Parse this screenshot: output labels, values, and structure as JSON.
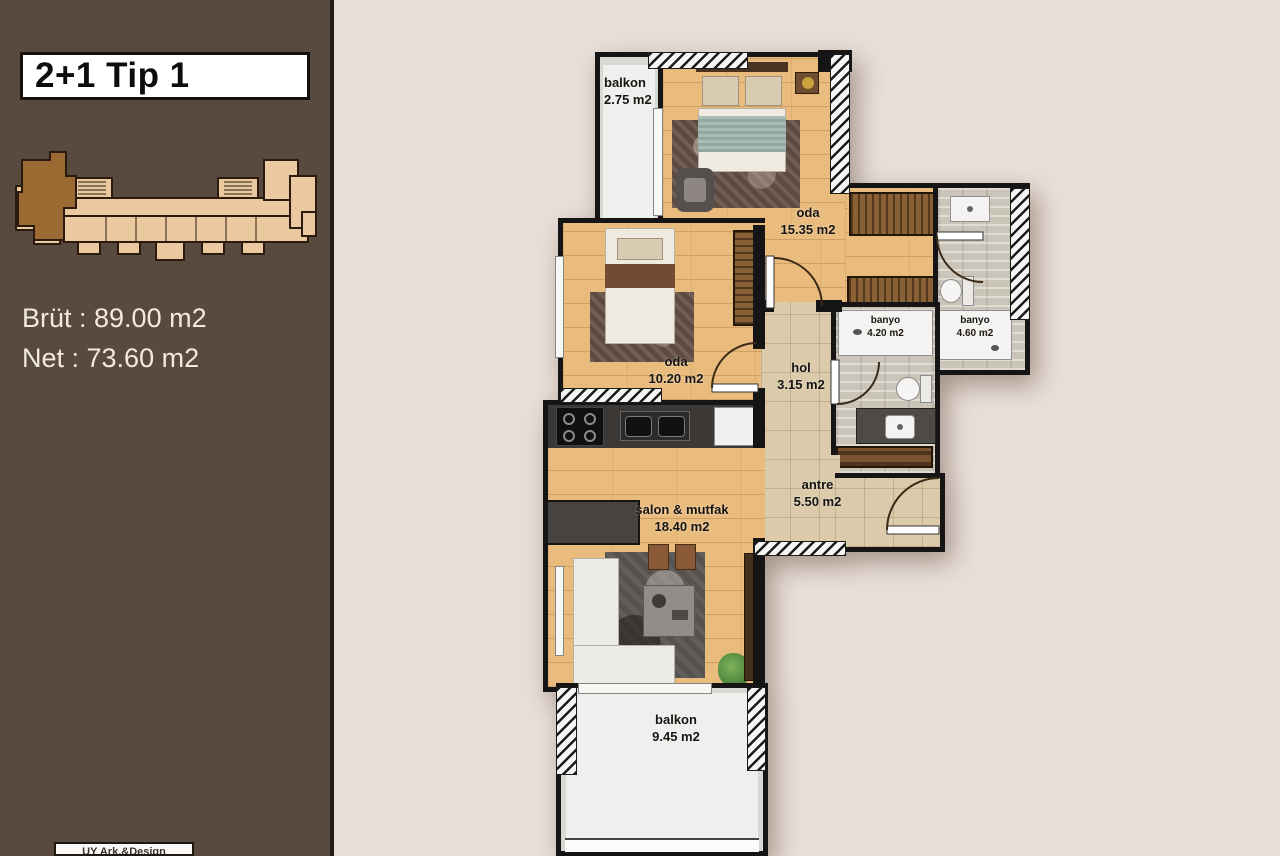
{
  "sidebar": {
    "title": "2+1 Tip 1",
    "gross_label": "Brüt : 89.00 m2",
    "net_label": "Net : 73.60 m2",
    "credit": "UY Ark.&Design"
  },
  "plan": {
    "rooms": {
      "balkon_top": {
        "name": "balkon",
        "area": "2.75 m2"
      },
      "oda_master": {
        "name": "oda",
        "area": "15.35 m2"
      },
      "oda_small": {
        "name": "oda",
        "area": "10.20 m2"
      },
      "hol": {
        "name": "hol",
        "area": "3.15 m2"
      },
      "banyo_small": {
        "name": "banyo",
        "area": "4.20 m2"
      },
      "banyo_large": {
        "name": "banyo",
        "area": "4.60 m2"
      },
      "antre": {
        "name": "antre",
        "area": "5.50 m2"
      },
      "salon": {
        "name": "salon & mutfak",
        "area": "18.40 m2"
      },
      "balkon_bottom": {
        "name": "balkon",
        "area": "9.45 m2"
      }
    },
    "colors": {
      "sidebar_bg": "#594a40",
      "canvas_bg": "#e9dfd9",
      "wall": "#151515",
      "wood_floor": "#e9bc7e",
      "tile_floor": "#dbcbab",
      "bath_floor": "#cbc4b8",
      "balcony_floor": "#d9d8d5",
      "keyplan_fill": "#eac9a1",
      "keyplan_highlight": "#9b6a33"
    }
  }
}
